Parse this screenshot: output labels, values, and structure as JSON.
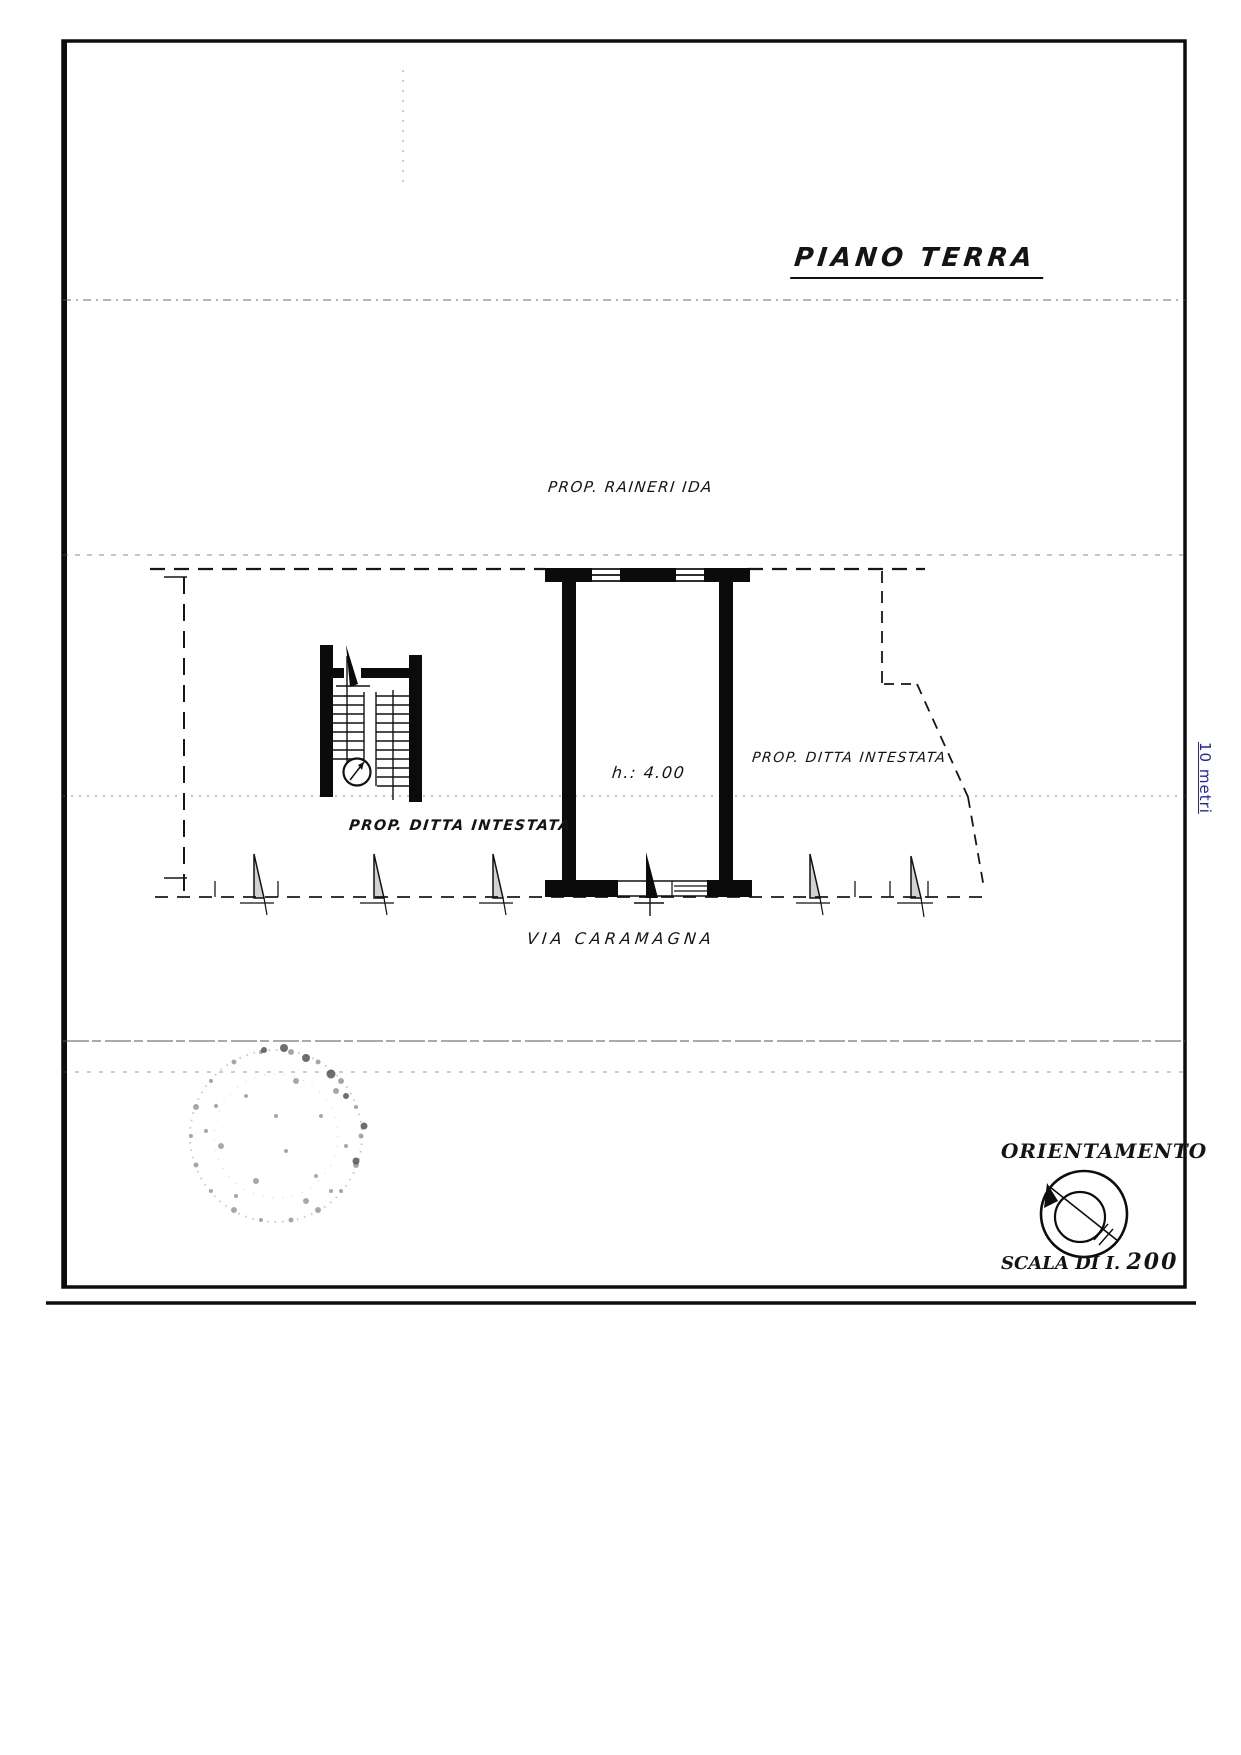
{
  "page": {
    "title": "PIANO TERRA",
    "labels": {
      "owner_top": "PROP. RAINERI IDA",
      "owner_right": "PROP. DITTA INTESTATA",
      "owner_left": "PROP. DITTA INTESTATA",
      "street": "VIA CARAMAGNA",
      "room_height": "h.: 4.00"
    },
    "orientation": {
      "title": "ORIENTAMENTO",
      "scale_prefix": "SCALA DI I.",
      "scale_value": "200"
    },
    "margin_note": "10 metri",
    "icons": {
      "compass": "compass-icon",
      "stamp": "stamp-icon"
    },
    "colors": {
      "ink": "#111111",
      "margin_note_blue": "#2323b0",
      "stamp_gray": "#8d8d8d",
      "paper": "#ffffff"
    }
  }
}
